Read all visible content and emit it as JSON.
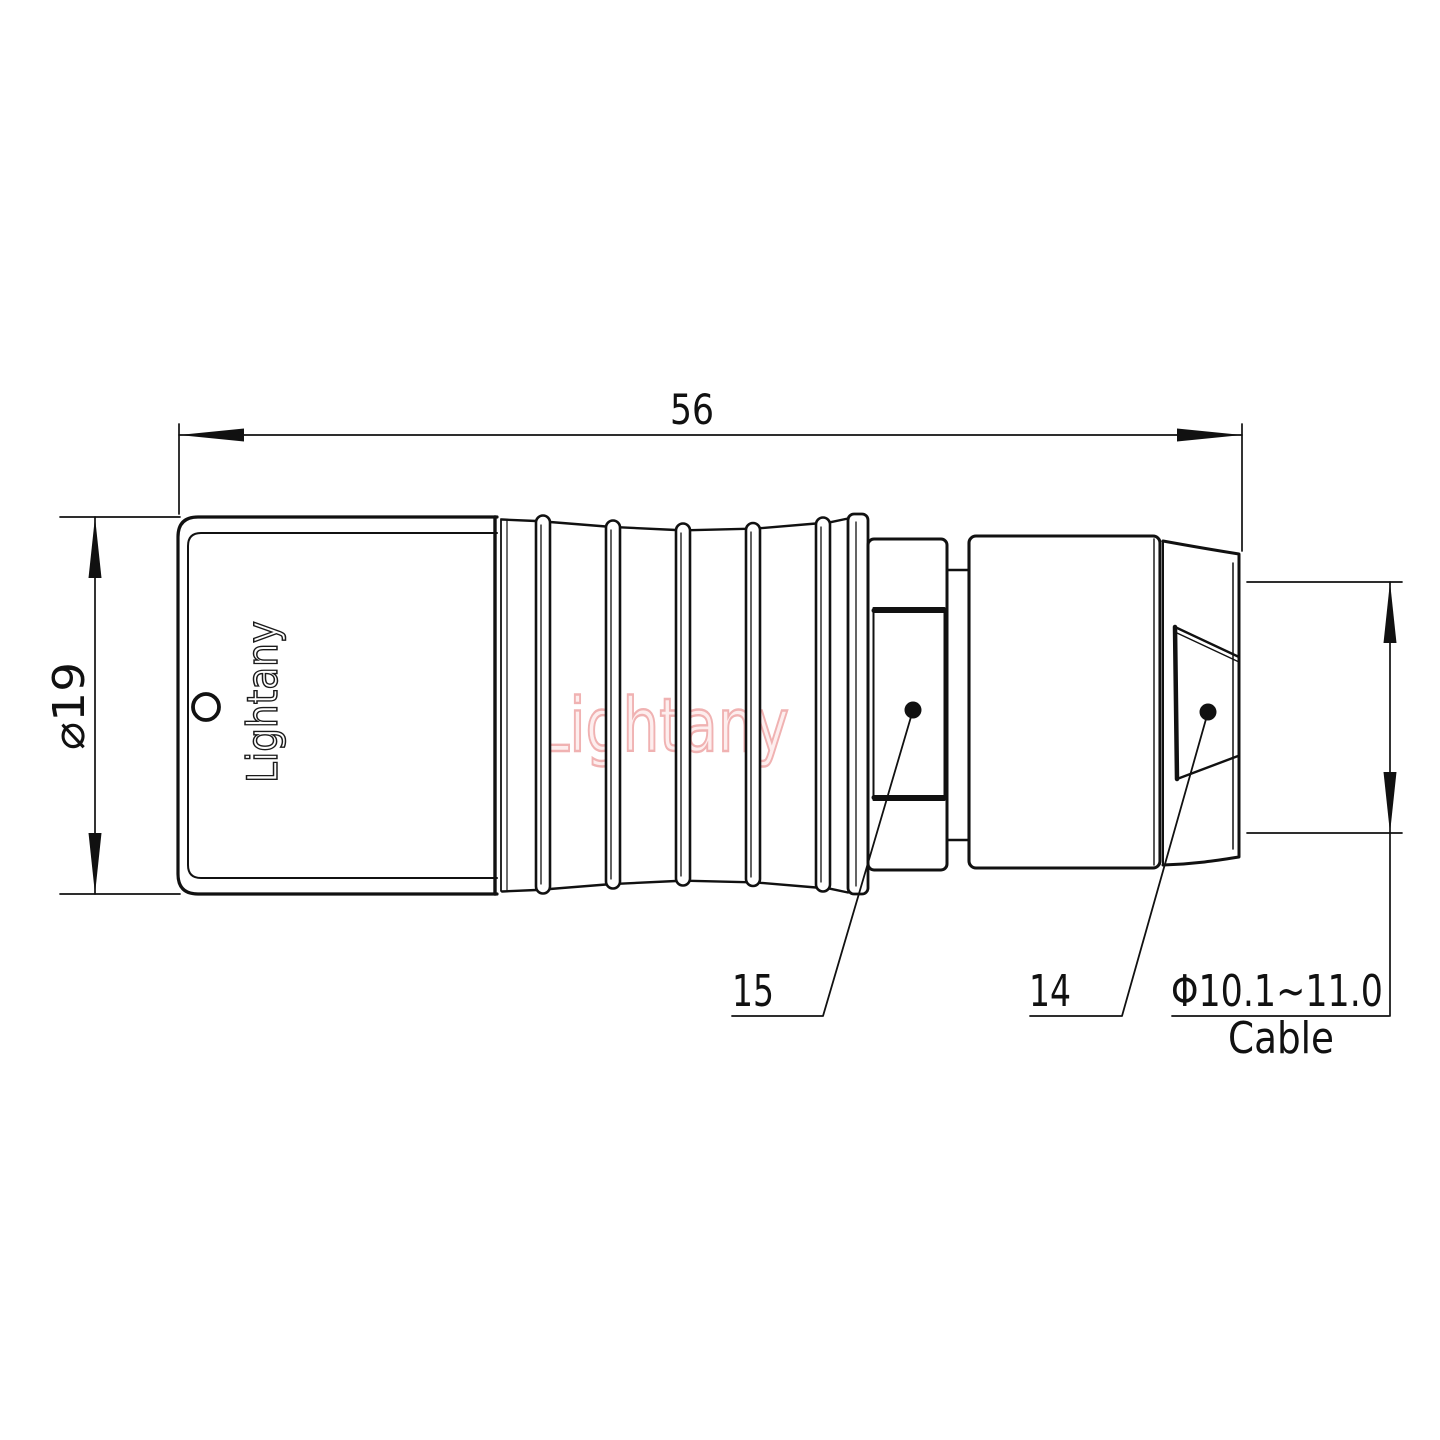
{
  "drawing": {
    "type": "connector-technical-drawing",
    "view": "side-view-with-dimensions"
  },
  "labels": {
    "dim_length": "56",
    "dim_diameter": "⌀19",
    "part_15": "15",
    "part_14": "14",
    "cable_diameter": "Φ10.1~11.0",
    "cable": "Cable",
    "brand": "Lightany",
    "watermark": "Lightany"
  },
  "colors": {
    "line": "#111111",
    "background": "#ffffff",
    "watermark_stroke": "#f0b2b2",
    "watermark_fill": "#fdeeee",
    "brand_outline": "#1b1b1b"
  }
}
